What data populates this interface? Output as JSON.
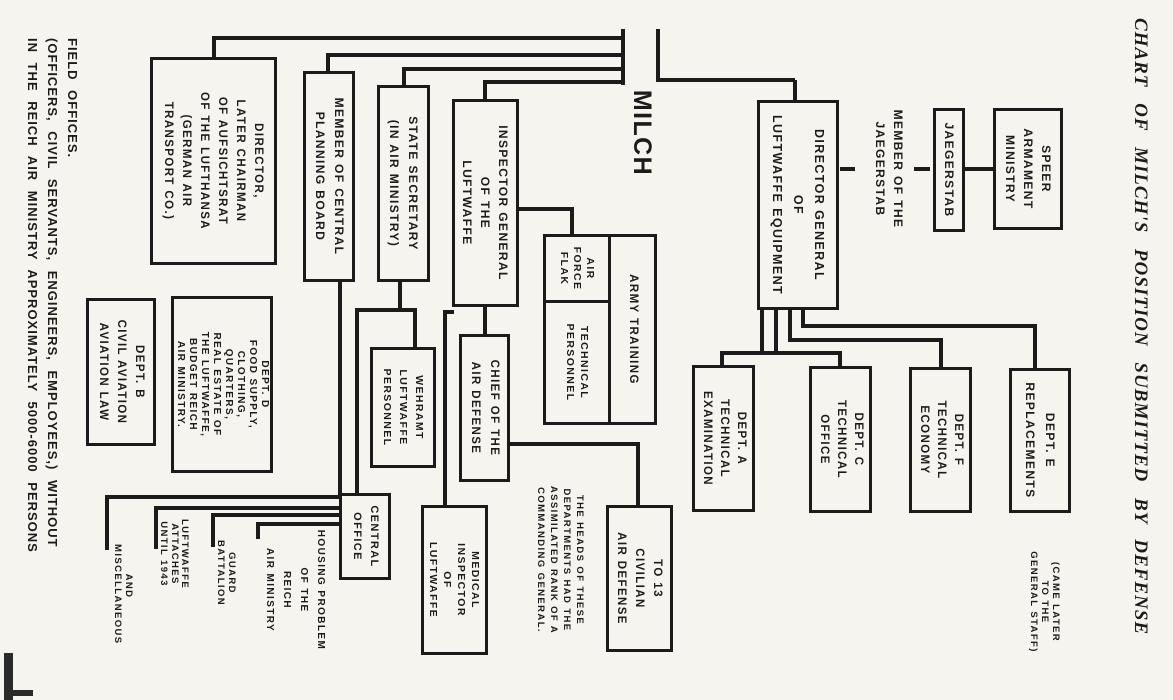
{
  "page": {
    "ink_color": "#1b1b1b",
    "paper_color": "#f6f4ee",
    "title": "CHART OF MILCH'S POSITION SUBMITTED BY DEFENSE",
    "footnote_lines": [
      "FIELD OFFICES.",
      "(OFFICERS, CIVIL SERVANTS, ENGINEERS, EMPLOYEES,) WITHOUT",
      "IN THE REICH AIR MINISTRY APPROXIMATELY 5000-6000 PERSONS"
    ]
  },
  "chart": {
    "type": "org-chart",
    "nodes": [
      {
        "id": "speer-armament-ministry",
        "box": true,
        "x": 108,
        "y": 110,
        "w": 122,
        "h": 70,
        "font": 12,
        "lh": 18,
        "lines": [
          "SPEER",
          "ARMAMENT",
          "MINISTRY"
        ]
      },
      {
        "id": "jaegerstab",
        "box": true,
        "x": 108,
        "y": 208,
        "w": 124,
        "h": 32,
        "font": 12,
        "lh": 14,
        "lines": [
          "JAEGERSTAB"
        ]
      },
      {
        "id": "member-of-the-jaegerstab",
        "box": false,
        "x": 90,
        "y": 264,
        "w": 158,
        "h": 40,
        "font": 12,
        "lh": 18,
        "lines": [
          "MEMBER OF THE",
          "JAEGERSTAB"
        ]
      },
      {
        "id": "dept-e-replacements",
        "box": true,
        "x": 368,
        "y": 102,
        "w": 145,
        "h": 62,
        "font": 12,
        "lh": 20,
        "lines": [
          "DEPT. E",
          "REPLACEMENTS"
        ]
      },
      {
        "id": "came-later-note",
        "box": false,
        "x": 538,
        "y": 108,
        "w": 128,
        "h": 40,
        "font": 9.5,
        "lh": 11,
        "lines": [
          "(CAME LATER",
          "TO THE",
          "GENERAL STAFF)"
        ]
      },
      {
        "id": "dept-f-technical-economy",
        "box": true,
        "x": 367,
        "y": 201,
        "w": 146,
        "h": 63,
        "font": 11.5,
        "lh": 17,
        "lines": [
          "DEPT. F",
          "TECHNICAL",
          "ECONOMY"
        ]
      },
      {
        "id": "dept-c-technical-office",
        "box": true,
        "x": 366,
        "y": 301,
        "w": 147,
        "h": 63,
        "font": 11.5,
        "lh": 17,
        "lines": [
          "DEPT. C",
          "TECHNICAL",
          "OFFICE"
        ]
      },
      {
        "id": "director-general-luftwaffe-equipment",
        "box": true,
        "x": 100,
        "y": 334,
        "w": 210,
        "h": 82,
        "font": 12.5,
        "lh": 21,
        "lines": [
          "DIRECTOR GENERAL",
          "OF",
          "LUFTWAFFE EQUIPMENT"
        ]
      },
      {
        "id": "dept-a-technical-examination",
        "box": true,
        "x": 365,
        "y": 418,
        "w": 147,
        "h": 63,
        "font": 11.5,
        "lh": 17,
        "lines": [
          "DEPT. A",
          "TECHNICAL",
          "EXAMINATION"
        ]
      },
      {
        "id": "milch",
        "box": false,
        "x": 86,
        "y": 514,
        "w": 94,
        "h": 34,
        "font": 25,
        "lh": 30,
        "lines": [
          "MILCH"
        ]
      },
      {
        "id": "to-13-civilian-air-defense",
        "box": true,
        "x": 505,
        "y": 500,
        "w": 147,
        "h": 67,
        "font": 11.5,
        "lh": 18,
        "lines": [
          "TO 13",
          "CIVILIAN",
          "AIR DEFENSE"
        ]
      },
      {
        "id": "army-training",
        "box": true,
        "x": 234,
        "y": 516,
        "w": 191,
        "h": 49,
        "font": 11.5,
        "lh": 15,
        "lines": [
          "ARMY TRAINING"
        ]
      },
      {
        "id": "air-force-flak",
        "box": true,
        "x": 234,
        "y": 562,
        "w": 69,
        "h": 68,
        "font": 10.5,
        "lh": 13,
        "lines": [
          "AIR",
          "FORCE",
          "FLAK"
        ]
      },
      {
        "id": "technical-personnel",
        "box": true,
        "x": 300,
        "y": 562,
        "w": 125,
        "h": 68,
        "font": 10.5,
        "lh": 14,
        "lines": [
          "TECHNICAL",
          "PERSONNEL"
        ]
      },
      {
        "id": "assimilated-rank-note",
        "box": false,
        "x": 476,
        "y": 582,
        "w": 168,
        "h": 62,
        "font": 9.5,
        "lh": 13,
        "lines": [
          "THE HEADS OF THESE",
          "DEPARTMENTS HAD THE",
          "ASSIMILATED RANK OF A",
          "COMMANDING GENERAL."
        ]
      },
      {
        "id": "inspector-general-of-the-luftwaffe",
        "box": true,
        "x": 99,
        "y": 654,
        "w": 208,
        "h": 67,
        "font": 12,
        "lh": 18,
        "lines": [
          "INSPECTOR GENERAL",
          "OF THE",
          "LUFTWAFFE"
        ]
      },
      {
        "id": "chief-of-the-air-defense",
        "box": true,
        "x": 334,
        "y": 663,
        "w": 148,
        "h": 51,
        "font": 11.5,
        "lh": 19,
        "lines": [
          "CHIEF OF THE",
          "AIR DEFENSE"
        ]
      },
      {
        "id": "medical-inspector-of-luftwaffe",
        "box": true,
        "x": 505,
        "y": 685,
        "w": 150,
        "h": 67,
        "font": 10.5,
        "lh": 14,
        "lines": [
          "MEDICAL",
          "INSPECTOR",
          "OF",
          "LUFTWAFFE"
        ]
      },
      {
        "id": "wehramt-luftwaffe-personnel",
        "box": true,
        "x": 347,
        "y": 737,
        "w": 121,
        "h": 66,
        "font": 10.5,
        "lh": 16,
        "lines": [
          "WEHRAMT",
          "LUFTWAFFE",
          "PERSONNEL"
        ]
      },
      {
        "id": "state-secretary",
        "box": true,
        "x": 85,
        "y": 743,
        "w": 197,
        "h": 53,
        "font": 12,
        "lh": 19,
        "lines": [
          "STATE SECRETARY",
          "(IN AIR MINISTRY)"
        ]
      },
      {
        "id": "central-office",
        "box": true,
        "x": 493,
        "y": 782,
        "w": 87,
        "h": 52,
        "font": 11,
        "lh": 17,
        "lines": [
          "CENTRAL",
          "OFFICE"
        ]
      },
      {
        "id": "member-central-planning-board",
        "box": true,
        "x": 71,
        "y": 818,
        "w": 211,
        "h": 52,
        "font": 12,
        "lh": 19,
        "lines": [
          "MEMBER OF CENTRAL",
          "PLANNING BOARD"
        ]
      },
      {
        "id": "director-lufthansa",
        "box": true,
        "x": 57,
        "y": 896,
        "w": 208,
        "h": 127,
        "font": 11.5,
        "lh": 18,
        "lines": [
          "DIRECTOR,",
          "LATER CHAIRMAN",
          "OF AUFSICHTSRAT",
          "OF THE LUFTHANSA",
          "(GERMAN AIR",
          "TRANSPORT CO.)"
        ]
      },
      {
        "id": "dept-d-food-supply",
        "box": true,
        "x": 296,
        "y": 900,
        "w": 177,
        "h": 102,
        "font": 10,
        "lh": 12,
        "lines": [
          "DEPT. D",
          "FOOD SUPPLY,",
          "CLOTHING,",
          "QUARTERS,",
          "REAL ESTATE OF",
          "THE LUFTWAFFE,",
          "BUDGET REICH",
          "AIR MINISTRY."
        ]
      },
      {
        "id": "dept-b-civil-aviation",
        "box": true,
        "x": 298,
        "y": 1017,
        "w": 148,
        "h": 70,
        "font": 11.5,
        "lh": 18,
        "lines": [
          "DEPT. B",
          "CIVIL AVIATION",
          "AVIATION LAW"
        ]
      },
      {
        "id": "housing-problem-label",
        "box": false,
        "x": 523,
        "y": 842,
        "w": 134,
        "h": 72,
        "font": 10,
        "lh": 17,
        "lines": [
          "HOUSING PROBLEM",
          "OF THE",
          "REICH",
          "AIR MINISTRY"
        ]
      },
      {
        "id": "guard-battalion-label",
        "box": false,
        "x": 528,
        "y": 936,
        "w": 90,
        "h": 23,
        "font": 9.5,
        "lh": 10.5,
        "lines": [
          "GUARD",
          "BATTALION"
        ]
      },
      {
        "id": "luftwaffe-attaches-label",
        "box": false,
        "x": 516,
        "y": 983,
        "w": 76,
        "h": 33,
        "font": 9.5,
        "lh": 10.5,
        "lines": [
          "LUFTWAFFE",
          "ATTACHES",
          "UNTIL 1943"
        ]
      },
      {
        "id": "and-miscellaneous-label",
        "box": false,
        "x": 544,
        "y": 1039,
        "w": 84,
        "h": 23,
        "font": 9.5,
        "lh": 10.5,
        "lines": [
          "AND",
          "MISCELLANEOUS"
        ]
      }
    ],
    "connectors": [
      {
        "x": 29,
        "y": 513,
        "w": 53,
        "h": 4
      },
      {
        "x": 78,
        "y": 378,
        "w": 4,
        "h": 139
      },
      {
        "x": 80,
        "y": 376,
        "w": 22,
        "h": 4
      },
      {
        "x": 167,
        "y": 318,
        "w": 4,
        "h": 15
      },
      {
        "x": 167,
        "y": 243,
        "w": 4,
        "h": 16
      },
      {
        "x": 167,
        "y": 180,
        "w": 4,
        "h": 29
      },
      {
        "x": 310,
        "y": 395,
        "w": 45,
        "h": 4
      },
      {
        "x": 310,
        "y": 409,
        "w": 45,
        "h": 4
      },
      {
        "x": 351,
        "y": 331,
        "w": 4,
        "h": 122
      },
      {
        "x": 351,
        "y": 331,
        "w": 17,
        "h": 4
      },
      {
        "x": 351,
        "y": 449,
        "w": 17,
        "h": 4
      },
      {
        "x": 310,
        "y": 381,
        "w": 32,
        "h": 4
      },
      {
        "x": 338,
        "y": 230,
        "w": 4,
        "h": 155
      },
      {
        "x": 338,
        "y": 230,
        "w": 31,
        "h": 4
      },
      {
        "x": 310,
        "y": 368,
        "w": 18,
        "h": 4
      },
      {
        "x": 324,
        "y": 136,
        "w": 4,
        "h": 236
      },
      {
        "x": 324,
        "y": 136,
        "w": 46,
        "h": 4
      },
      {
        "x": 29,
        "y": 548,
        "w": 56,
        "h": 4
      },
      {
        "x": 36,
        "y": 548,
        "w": 4,
        "h": 413
      },
      {
        "x": 36,
        "y": 957,
        "w": 23,
        "h": 4
      },
      {
        "x": 53,
        "y": 548,
        "w": 4,
        "h": 299
      },
      {
        "x": 53,
        "y": 843,
        "w": 20,
        "h": 4
      },
      {
        "x": 67,
        "y": 548,
        "w": 4,
        "h": 223
      },
      {
        "x": 67,
        "y": 767,
        "w": 20,
        "h": 4
      },
      {
        "x": 80,
        "y": 548,
        "w": 4,
        "h": 142
      },
      {
        "x": 80,
        "y": 686,
        "w": 21,
        "h": 4
      },
      {
        "x": 207,
        "y": 599,
        "w": 4,
        "h": 57
      },
      {
        "x": 207,
        "y": 599,
        "w": 29,
        "h": 4
      },
      {
        "x": 305,
        "y": 686,
        "w": 31,
        "h": 4
      },
      {
        "x": 442,
        "y": 533,
        "w": 4,
        "h": 132
      },
      {
        "x": 442,
        "y": 533,
        "w": 65,
        "h": 4
      },
      {
        "x": 310,
        "y": 719,
        "w": 4,
        "h": 11
      },
      {
        "x": 310,
        "y": 726,
        "w": 197,
        "h": 4
      },
      {
        "x": 280,
        "y": 771,
        "w": 32,
        "h": 4
      },
      {
        "x": 308,
        "y": 756,
        "w": 4,
        "h": 62
      },
      {
        "x": 308,
        "y": 756,
        "w": 41,
        "h": 4
      },
      {
        "x": 308,
        "y": 814,
        "w": 187,
        "h": 4
      },
      {
        "x": 280,
        "y": 831,
        "w": 215,
        "h": 4
      },
      {
        "x": 495,
        "y": 832,
        "w": 4,
        "h": 236
      },
      {
        "x": 495,
        "y": 1064,
        "w": 55,
        "h": 4
      },
      {
        "x": 506,
        "y": 832,
        "w": 4,
        "h": 187
      },
      {
        "x": 506,
        "y": 1015,
        "w": 43,
        "h": 4
      },
      {
        "x": 513,
        "y": 832,
        "w": 4,
        "h": 130
      },
      {
        "x": 513,
        "y": 958,
        "w": 34,
        "h": 4
      },
      {
        "x": 522,
        "y": 832,
        "w": 4,
        "h": 85
      },
      {
        "x": 522,
        "y": 913,
        "w": 17,
        "h": 4
      }
    ]
  }
}
